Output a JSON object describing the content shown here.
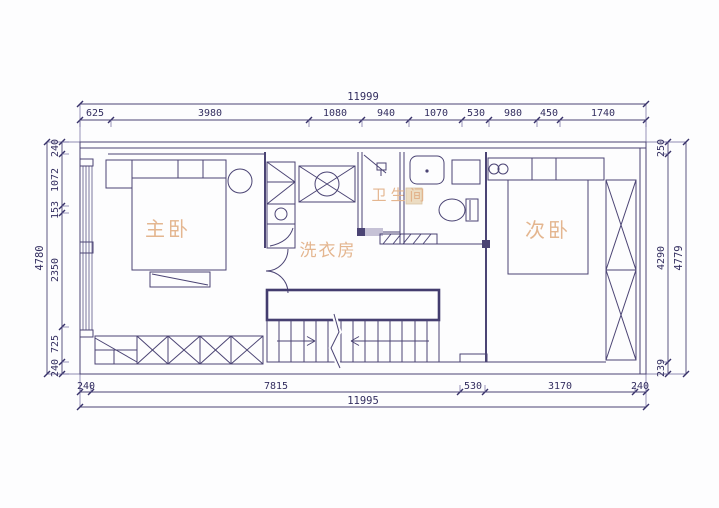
{
  "drawing": {
    "type": "floor-plan",
    "colors": {
      "line": "#4b4474",
      "dim_text": "#332e60",
      "room_label": "#e2b087",
      "paper": "#fdfdfe"
    }
  },
  "rooms": {
    "master_bedroom": "主卧",
    "laundry": "洗衣房",
    "bathroom": "卫生间",
    "second_bedroom": "次卧"
  },
  "dimensions": {
    "top": {
      "overall": "11999",
      "segments": [
        "625",
        "3980",
        "1080",
        "940",
        "1070",
        "530",
        "980",
        "450",
        "1740"
      ]
    },
    "bottom": {
      "overall": "11995",
      "segments": [
        "240",
        "7815",
        "530",
        "3170",
        "240"
      ]
    },
    "left": {
      "overall": "4780",
      "segments": [
        "240",
        "1072",
        "153",
        "2350",
        "725",
        "240"
      ]
    },
    "right": {
      "overall": "4779",
      "segments": [
        "250",
        "4290",
        "239"
      ]
    }
  }
}
